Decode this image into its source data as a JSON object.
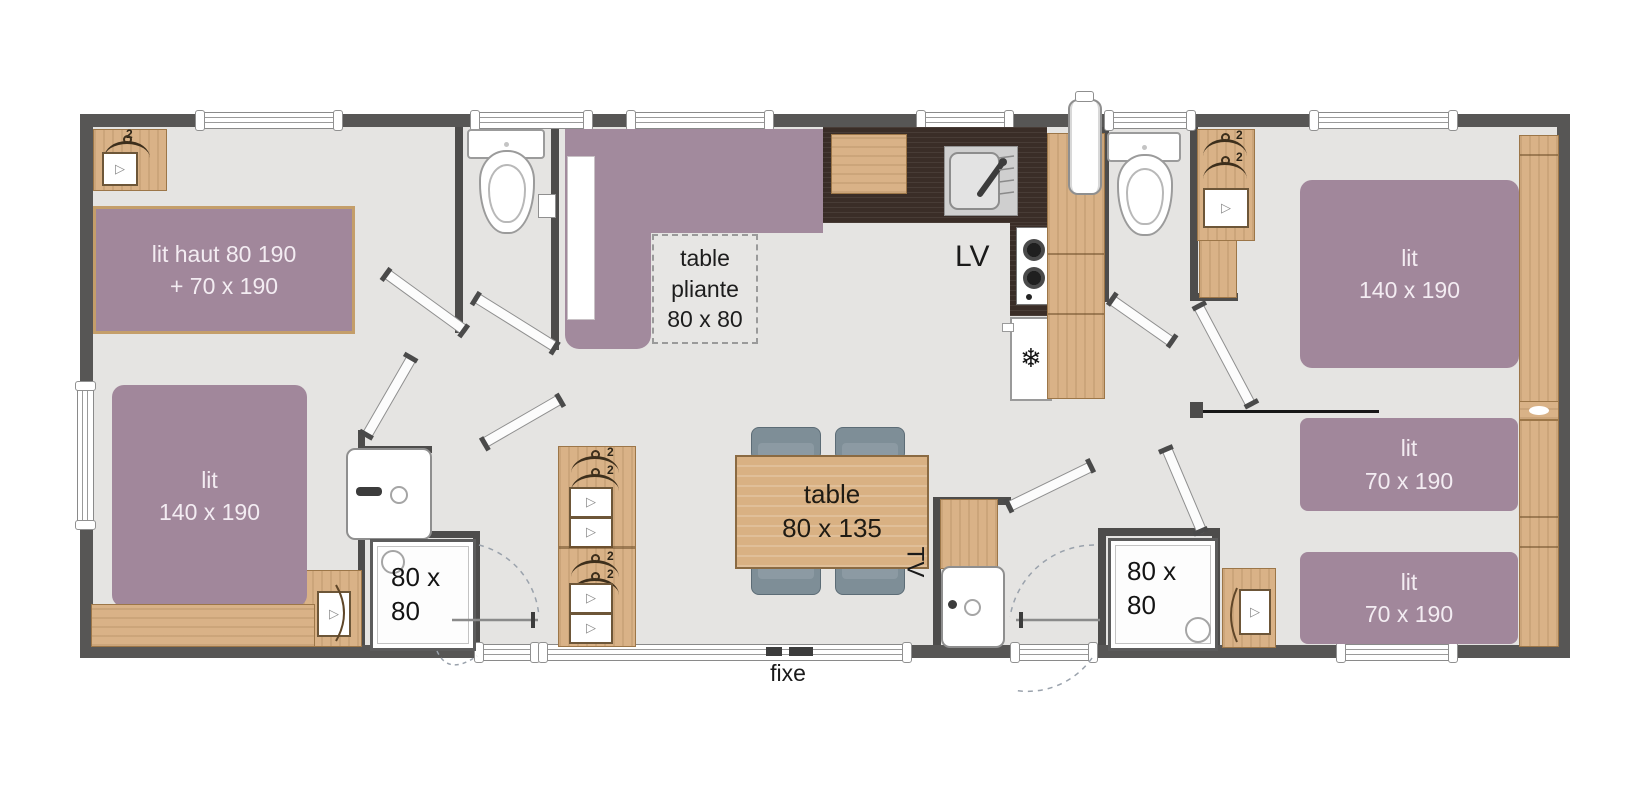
{
  "plan_labels": {
    "bunk_line1": "lit haut 80 190",
    "bunk_line2": "+ 70 x 190",
    "double_line1": "lit",
    "double_line2": "140 x 190",
    "single_line1": "lit",
    "single_line2": "70 x 190",
    "folding_line1": "table",
    "folding_line2": "pliante",
    "folding_line3": "80 x 80",
    "table_line1": "table",
    "table_line2": "80 x 135",
    "shower_line1": "80 x",
    "shower_line2": "80",
    "dishwasher": "LV",
    "tv": "TV",
    "fixed": "fixe",
    "hanger_capacity": "2"
  },
  "colors": {
    "bed_purple": "#a1879b",
    "wood": "#d9b287",
    "wall_dark": "#575655",
    "floor_gray": "#e5e4e2",
    "counter_dark": "#3a2d27",
    "chair_gray": "#7e8e97"
  }
}
